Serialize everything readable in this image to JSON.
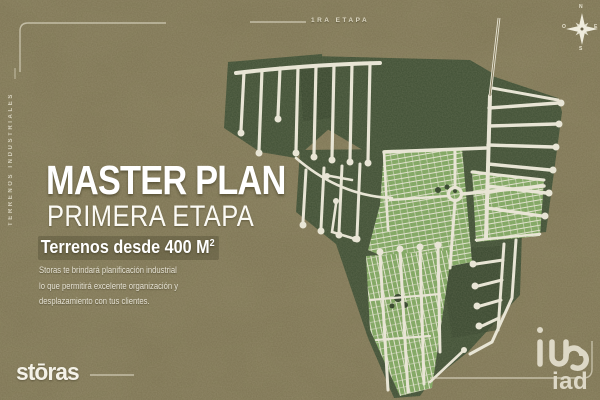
{
  "frame": {
    "stage_label": "1RA ETAPA",
    "side_label": "TERRENOS INDUSTRIALES"
  },
  "headline": {
    "title": "MASTER PLAN",
    "subtitle": "PRIMERA ETAPA",
    "badge_text": "Terrenos desde 400 M",
    "badge_sup": "2",
    "body_lines": [
      "Storas te brindará planificación industrial",
      "lo que permitirá excelente organización y",
      "desplazamiento con tus clientes."
    ]
  },
  "logos": {
    "storas": "stōras",
    "iad": "iad"
  },
  "compass": {
    "n": "N",
    "s": "S",
    "e": "E",
    "w": "O"
  },
  "colors": {
    "ground": "#7b7251",
    "plan_dark_green": "#3e4e33",
    "lot_green": "#7ca45e",
    "road": "#e8e5d6",
    "cream_accent": "#ddd8c4",
    "text_white": "#ffffff"
  }
}
